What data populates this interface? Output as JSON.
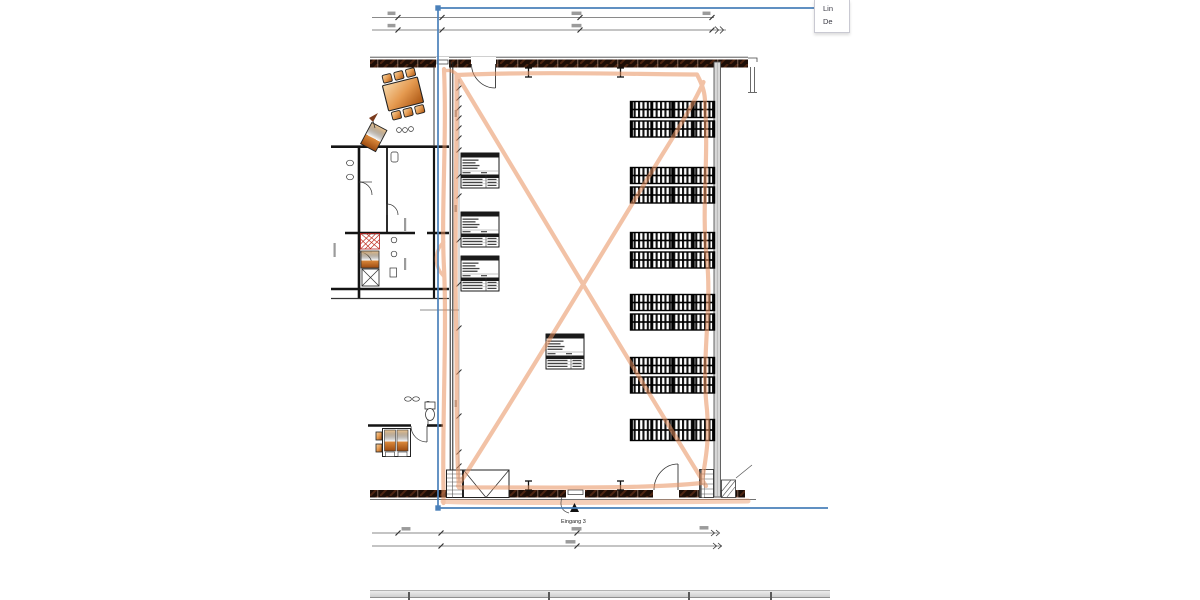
{
  "window": {
    "background": "#ffffff"
  },
  "context_panel": {
    "items": [
      {
        "label": "Lin"
      },
      {
        "label": "De"
      }
    ]
  },
  "plan": {
    "entrance_label": "Eingang 3",
    "colors": {
      "selection_blue": "#4a80ba",
      "route_orange": "#e8915f",
      "wall_dark": "#1d0e07",
      "wood_light": "#f6d8aa",
      "wood_dark": "#a8520f",
      "rack_black": "#131313",
      "dimension_gray": "#8a8a8a",
      "right_wall_gray": "#d8d8d8"
    },
    "racks": {
      "x": 630.5,
      "width": 84,
      "bays": 4,
      "row_height": 16,
      "row_gap": 3.5,
      "groups": [
        {
          "y": 101.5,
          "rows": 2
        },
        {
          "y": 167.5,
          "rows": 2
        },
        {
          "y": 232.5,
          "rows": 2
        },
        {
          "y": 294.5,
          "rows": 2
        },
        {
          "y": 357.5,
          "rows": 2
        },
        {
          "y": 419.5,
          "rows": 1,
          "row_height": 21
        }
      ]
    },
    "room_stamps": [
      {
        "x": 461,
        "y": 153
      },
      {
        "x": 461,
        "y": 212
      },
      {
        "x": 461,
        "y": 256
      },
      {
        "x": 546,
        "y": 334
      }
    ]
  },
  "bottom_table": {
    "x": 370,
    "width": 460,
    "separators_x": [
      408,
      548,
      688,
      770
    ]
  }
}
